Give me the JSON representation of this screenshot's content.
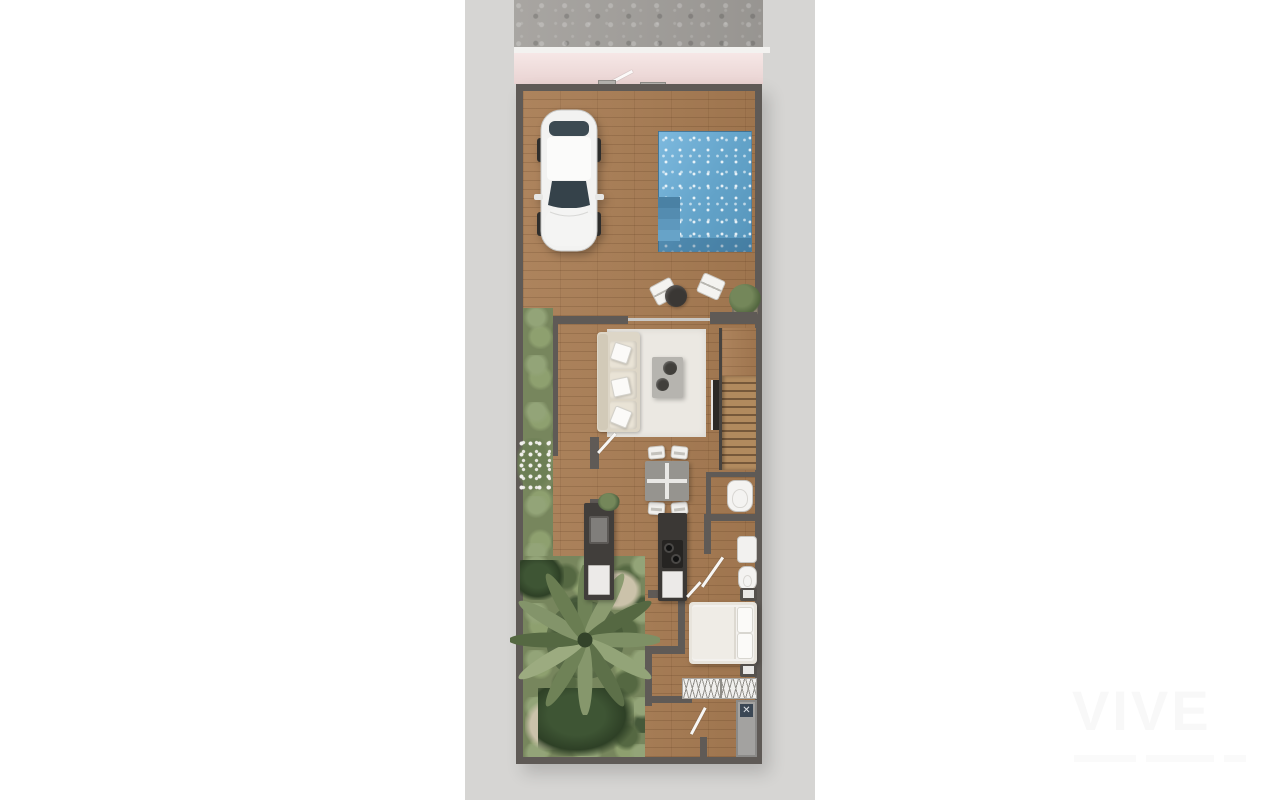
{
  "watermark": {
    "brand": "VIVE"
  },
  "colors": {
    "page_bg": "#ffffff",
    "canvas_bg": "#d6d5d3",
    "wall": "#5f5a56",
    "wood_deck": "#a87c53",
    "pool_water": "#63a3c9",
    "garden_green": "#77865d",
    "concrete_street": "#a3a09c",
    "sidewalk_pink": "#eedad9",
    "rug": "#ebe8e2",
    "watermark": "#f8f8f8"
  },
  "scene": {
    "description": "Top-down 3D rendered floor plan of a narrow villa plot with driveway, pool, terrace, garden, living-dining area, kitchen, bedroom and bathrooms",
    "objects": {
      "street": "street pavement",
      "sidewalk": "pink sidewalk with entrance gate",
      "gate": "open pedestrian gate",
      "car": "white car parked on driveway",
      "pool": "swimming pool with corner steps",
      "lounge": "two lounge chairs with round side table",
      "plant": "potted plant on terrace",
      "garden": "side garden with palm tree and shrubs",
      "palm": "palm tree seen from above",
      "rug": "cream area rug",
      "sofa": "cream three-seat sofa with pillows",
      "coffee_table": "coffee table with two round trays",
      "tv": "wall-mounted TV",
      "stairs": "wooden staircase",
      "wc": "guest toilet",
      "dining": "dining table with four chairs",
      "kitchen": "kitchen counter with sink and appliance",
      "island": "kitchen island with cooktop",
      "bath_sink": "bathroom washbasin",
      "bath_toilet": "bathroom toilet",
      "bed": "double bed with pillows",
      "nightstand": "nightstand",
      "wardrobe": "built-in wardrobe with hangers",
      "shower": "walk-in shower",
      "door": "open interior door leaf"
    }
  }
}
